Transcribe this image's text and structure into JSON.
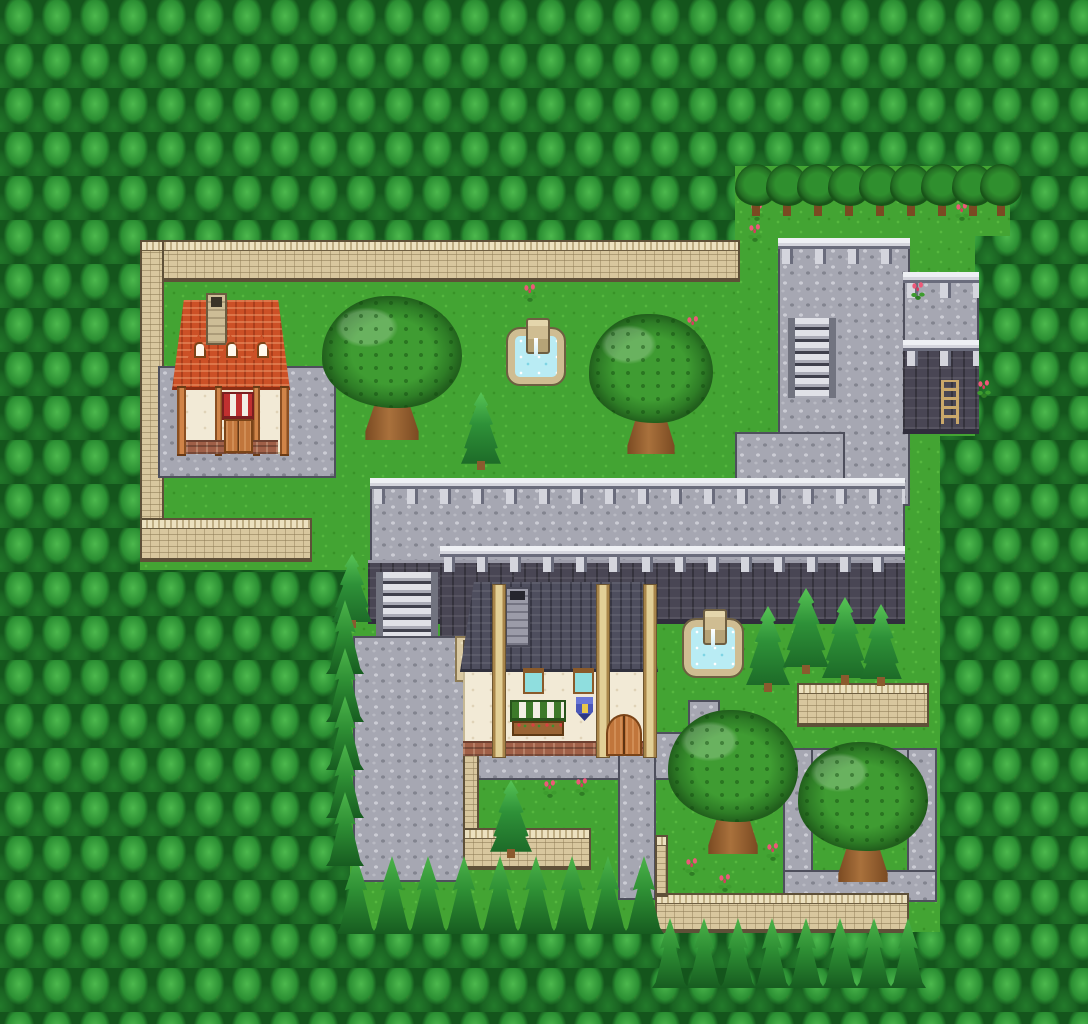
{
  "map": {
    "width": 1088,
    "height": 1024,
    "scene": "forest-town-map",
    "palette": {
      "grass": "#43a433",
      "grass_light": "#55b73e",
      "grass_dark": "#389327",
      "forest_dark": "#14551c",
      "forest_mid": "#2b8f33",
      "forest_light": "#4cb84d",
      "trunk_brown": "#8a5a2e",
      "cobble": "#a6a7b2",
      "cobble_light": "#cbccd4",
      "cobble_dark": "#82848f",
      "stone_border": "#4e4f5c",
      "step_light": "#e0e1e7",
      "step_dark": "#3f404c",
      "cliff": "#494654",
      "cliff_dark": "#302e3c",
      "cliff_cap": "#9b9ba8",
      "tan_cap": "#ece1bf",
      "tan_body": "#d8c79e",
      "tan_brick": "#b7a67c",
      "tan_dark": "#8c7a54",
      "roof_red": "#cc5026",
      "roof_red_dark": "#8c2e14",
      "roof_slate": "#4e4e5e",
      "roof_slate_dark": "#30303c",
      "cream": "#f2ead6",
      "wood": "#c1763c",
      "wood_dark": "#7a4418",
      "beam_tan": "#e2cf96",
      "water": "#b9ecf4",
      "fountain_stone": "#cfbd92",
      "fountain_stone_dark": "#6e5f42",
      "flower_pink": "#ee5878",
      "awning_green": "#3d7a2a",
      "awning_red": "#c03030",
      "awning_white": "#f2efe4",
      "shield_blue": "#4a57b8",
      "window_teal": "#8fdede",
      "brick_red": "#a06048",
      "rail_light": "#d4d5dd",
      "rail_dark": "#6a6c7c",
      "leaf_mid": "#3f9c32"
    },
    "elements": [
      {
        "n": "grass-upper-courtyard",
        "t": "grass",
        "x": 140,
        "y": 240,
        "w": 602,
        "h": 330
      },
      {
        "n": "grass-northeast-a",
        "t": "grass",
        "x": 735,
        "y": 166,
        "w": 275,
        "h": 70
      },
      {
        "n": "grass-northeast-b",
        "t": "grass",
        "x": 735,
        "y": 236,
        "w": 240,
        "h": 200
      },
      {
        "n": "grass-east",
        "t": "grass",
        "x": 735,
        "y": 436,
        "w": 205,
        "h": 126
      },
      {
        "n": "grass-south",
        "t": "grass",
        "x": 350,
        "y": 556,
        "w": 590,
        "h": 376
      },
      {
        "n": "stone-terrace-platform",
        "t": "cobble",
        "x": 778,
        "y": 244,
        "w": 132,
        "h": 262
      },
      {
        "n": "stone-terrace-annex",
        "t": "cobble",
        "x": 903,
        "y": 278,
        "w": 76,
        "h": 72
      },
      {
        "n": "terrace-connector",
        "t": "cobble",
        "x": 735,
        "y": 432,
        "w": 110,
        "h": 76
      },
      {
        "n": "elevated-walkway",
        "t": "cobble",
        "x": 370,
        "y": 484,
        "w": 535,
        "h": 80
      },
      {
        "n": "cliff-wall",
        "t": "cliff",
        "x": 368,
        "y": 560,
        "w": 537,
        "h": 64
      },
      {
        "n": "cliff-wall-corner",
        "t": "cliff",
        "x": 440,
        "y": 560,
        "w": 74,
        "h": 82
      },
      {
        "n": "annex-cliff-wall",
        "t": "cliff",
        "x": 903,
        "y": 346,
        "w": 76,
        "h": 88
      },
      {
        "n": "annex-ladder",
        "t": "ladder",
        "x": 941,
        "y": 380,
        "w": 18,
        "h": 44,
        "i": true
      },
      {
        "n": "platform-railing",
        "t": "railing",
        "x": 778,
        "y": 238,
        "w": 132,
        "h": 26
      },
      {
        "n": "annex-railing-top",
        "t": "railing",
        "x": 903,
        "y": 272,
        "w": 76,
        "h": 26
      },
      {
        "n": "annex-railing-mid",
        "t": "railing",
        "x": 903,
        "y": 340,
        "w": 76,
        "h": 26
      },
      {
        "n": "walkway-railing",
        "t": "railing",
        "x": 370,
        "y": 478,
        "w": 535,
        "h": 26
      },
      {
        "n": "cliff-top-railing",
        "t": "railing",
        "x": 440,
        "y": 546,
        "w": 465,
        "h": 26
      },
      {
        "n": "platform-stairs",
        "t": "stairs",
        "x": 788,
        "y": 318,
        "w": 48,
        "h": 80,
        "i": true
      },
      {
        "n": "walkway-stairs",
        "t": "stairs",
        "x": 376,
        "y": 572,
        "w": 62,
        "h": 94,
        "i": true
      },
      {
        "n": "north-wall",
        "t": "tanwall-h",
        "x": 140,
        "y": 240,
        "w": 600,
        "h": 42
      },
      {
        "n": "west-wall",
        "t": "tanwall-v",
        "x": 140,
        "y": 240,
        "w": 24,
        "h": 292
      },
      {
        "n": "west-wall-return",
        "t": "tanwall-h",
        "x": 140,
        "y": 518,
        "w": 172,
        "h": 44
      },
      {
        "n": "inn-patio",
        "t": "cobble",
        "x": 158,
        "y": 366,
        "w": 178,
        "h": 112
      },
      {
        "n": "inn-wall",
        "t": "wall-cream",
        "x": 177,
        "y": 388,
        "w": 112,
        "h": 66
      },
      {
        "n": "inn-roof",
        "t": "roof-red",
        "x": 172,
        "y": 300,
        "w": 118,
        "h": 90
      },
      {
        "n": "inn-chimney",
        "t": "chimney-stone",
        "x": 206,
        "y": 293,
        "w": 21,
        "h": 52
      },
      {
        "n": "inn-dormer",
        "t": "dormer",
        "x": 188,
        "y": 334,
        "w": 21,
        "h": 26
      },
      {
        "n": "inn-dormer",
        "t": "dormer",
        "x": 220,
        "y": 334,
        "w": 21,
        "h": 26
      },
      {
        "n": "inn-dormer",
        "t": "dormer",
        "x": 251,
        "y": 334,
        "w": 21,
        "h": 26
      },
      {
        "n": "inn-post",
        "t": "post-wood",
        "x": 177,
        "y": 386,
        "w": 9,
        "h": 70
      },
      {
        "n": "inn-post",
        "t": "post-wood",
        "x": 215,
        "y": 386,
        "w": 7,
        "h": 70
      },
      {
        "n": "inn-post",
        "t": "post-wood",
        "x": 253,
        "y": 386,
        "w": 7,
        "h": 70
      },
      {
        "n": "inn-post",
        "t": "post-wood",
        "x": 280,
        "y": 386,
        "w": 9,
        "h": 70
      },
      {
        "n": "inn-awning",
        "t": "awning-red",
        "x": 222,
        "y": 392,
        "w": 32,
        "h": 28
      },
      {
        "n": "inn-foundation",
        "t": "brick-base",
        "x": 186,
        "y": 440,
        "w": 92,
        "h": 14
      },
      {
        "n": "inn-door",
        "t": "door-wood",
        "x": 224,
        "y": 419,
        "w": 29,
        "h": 34,
        "i": true
      },
      {
        "n": "south-plaza",
        "t": "cobble",
        "x": 353,
        "y": 636,
        "w": 112,
        "h": 246
      },
      {
        "n": "shop-front-path",
        "t": "cobble",
        "x": 465,
        "y": 732,
        "w": 235,
        "h": 48
      },
      {
        "n": "south-path",
        "t": "cobble",
        "x": 618,
        "y": 732,
        "w": 38,
        "h": 168
      },
      {
        "n": "fountain-path-stub",
        "t": "cobble",
        "x": 688,
        "y": 700,
        "w": 32,
        "h": 52
      },
      {
        "n": "garden-path-north",
        "t": "cobble",
        "x": 700,
        "y": 748,
        "w": 237,
        "h": 36
      },
      {
        "n": "garden-path-west",
        "t": "cobble",
        "x": 783,
        "y": 748,
        "w": 30,
        "h": 154
      },
      {
        "n": "garden-path-east",
        "t": "cobble",
        "x": 907,
        "y": 748,
        "w": 30,
        "h": 154
      },
      {
        "n": "garden-path-south",
        "t": "cobble",
        "x": 783,
        "y": 870,
        "w": 154,
        "h": 32
      },
      {
        "n": "side-yard",
        "t": "tan-floor",
        "x": 455,
        "y": 636,
        "w": 48,
        "h": 46
      },
      {
        "n": "yard-wall-vertical",
        "t": "tanwall-v",
        "x": 463,
        "y": 640,
        "w": 16,
        "h": 192
      },
      {
        "n": "yard-wall",
        "t": "tanwall-h",
        "x": 463,
        "y": 828,
        "w": 128,
        "h": 42
      },
      {
        "n": "south-wall",
        "t": "tanwall-h",
        "x": 655,
        "y": 893,
        "w": 254,
        "h": 40
      },
      {
        "n": "south-wall-stub",
        "t": "tanwall-v",
        "x": 655,
        "y": 835,
        "w": 13,
        "h": 62
      },
      {
        "n": "garden-wall",
        "t": "tanwall-h",
        "x": 797,
        "y": 683,
        "w": 132,
        "h": 44
      },
      {
        "n": "fountain",
        "t": "fountain",
        "x": 508,
        "y": 329,
        "w": 56,
        "h": 55
      },
      {
        "n": "oak-tree",
        "t": "big-tree",
        "x": 322,
        "y": 296,
        "w": 140,
        "h": 144
      },
      {
        "n": "oak-tree",
        "t": "big-tree",
        "x": 589,
        "y": 314,
        "w": 124,
        "h": 140
      },
      {
        "n": "grove-tree",
        "t": "small-tree",
        "x": 735,
        "y": 164,
        "w": 42,
        "h": 52
      },
      {
        "n": "grove-tree",
        "t": "small-tree",
        "x": 766,
        "y": 164,
        "w": 42,
        "h": 52
      },
      {
        "n": "grove-tree",
        "t": "small-tree",
        "x": 797,
        "y": 164,
        "w": 42,
        "h": 52
      },
      {
        "n": "grove-tree",
        "t": "small-tree",
        "x": 828,
        "y": 164,
        "w": 42,
        "h": 52
      },
      {
        "n": "grove-tree",
        "t": "small-tree",
        "x": 859,
        "y": 164,
        "w": 42,
        "h": 52
      },
      {
        "n": "grove-tree",
        "t": "small-tree",
        "x": 890,
        "y": 164,
        "w": 42,
        "h": 52
      },
      {
        "n": "grove-tree",
        "t": "small-tree",
        "x": 921,
        "y": 164,
        "w": 42,
        "h": 52
      },
      {
        "n": "grove-tree",
        "t": "small-tree",
        "x": 952,
        "y": 164,
        "w": 42,
        "h": 52
      },
      {
        "n": "grove-tree",
        "t": "small-tree",
        "x": 980,
        "y": 164,
        "w": 42,
        "h": 52
      },
      {
        "n": "shop-wall",
        "t": "wall-cream",
        "x": 463,
        "y": 666,
        "w": 193,
        "h": 90
      },
      {
        "n": "shop-roof",
        "t": "roof-slate",
        "x": 460,
        "y": 582,
        "w": 198,
        "h": 90
      },
      {
        "n": "shop-chimney",
        "t": "chimney-slate",
        "x": 505,
        "y": 587,
        "w": 25,
        "h": 60
      },
      {
        "n": "shop-foundation",
        "t": "brick-base",
        "x": 463,
        "y": 741,
        "w": 193,
        "h": 15
      },
      {
        "n": "shop-beam",
        "t": "beam",
        "x": 492,
        "y": 584,
        "w": 14,
        "h": 174
      },
      {
        "n": "shop-beam",
        "t": "beam",
        "x": 596,
        "y": 584,
        "w": 14,
        "h": 174
      },
      {
        "n": "shop-beam",
        "t": "beam",
        "x": 643,
        "y": 584,
        "w": 14,
        "h": 174
      },
      {
        "n": "shop-window",
        "t": "window",
        "x": 523,
        "y": 668,
        "w": 21,
        "h": 26
      },
      {
        "n": "shop-window",
        "t": "window",
        "x": 573,
        "y": 668,
        "w": 21,
        "h": 26
      },
      {
        "n": "shop-awning",
        "t": "awning-green",
        "x": 510,
        "y": 700,
        "w": 56,
        "h": 22
      },
      {
        "n": "shop-flowerbox",
        "t": "flowerbox",
        "x": 512,
        "y": 721,
        "w": 52,
        "h": 15
      },
      {
        "n": "shop-sign-shield",
        "t": "shield",
        "x": 576,
        "y": 697,
        "w": 17,
        "h": 24
      },
      {
        "n": "shop-door",
        "t": "door-arch",
        "x": 606,
        "y": 714,
        "w": 36,
        "h": 42,
        "i": true
      },
      {
        "n": "fountain",
        "t": "fountain",
        "x": 684,
        "y": 620,
        "w": 58,
        "h": 56
      },
      {
        "n": "cypress-tree",
        "t": "conifer",
        "x": 461,
        "y": 392,
        "w": 40,
        "h": 78
      },
      {
        "n": "cypress-tree",
        "t": "conifer",
        "x": 332,
        "y": 554,
        "w": 40,
        "h": 74
      },
      {
        "n": "cypress-tree",
        "t": "conifer",
        "x": 746,
        "y": 606,
        "w": 44,
        "h": 86
      },
      {
        "n": "cypress-tree",
        "t": "conifer",
        "x": 783,
        "y": 588,
        "w": 46,
        "h": 86
      },
      {
        "n": "cypress-tree",
        "t": "conifer",
        "x": 822,
        "y": 597,
        "w": 46,
        "h": 88
      },
      {
        "n": "cypress-tree",
        "t": "conifer",
        "x": 860,
        "y": 604,
        "w": 42,
        "h": 82
      },
      {
        "n": "cypress-tree",
        "t": "conifer",
        "x": 490,
        "y": 780,
        "w": 42,
        "h": 78
      },
      {
        "n": "oak-tree",
        "t": "big-tree",
        "x": 668,
        "y": 710,
        "w": 130,
        "h": 144
      },
      {
        "n": "oak-tree",
        "t": "big-tree",
        "x": 798,
        "y": 742,
        "w": 130,
        "h": 140
      },
      {
        "n": "flower-patch",
        "t": "flower",
        "x": 521,
        "y": 284,
        "w": 18,
        "h": 18
      },
      {
        "n": "flower-patch",
        "t": "flower",
        "x": 684,
        "y": 316,
        "w": 18,
        "h": 18
      },
      {
        "n": "flower-patch",
        "t": "flower",
        "x": 748,
        "y": 203,
        "w": 18,
        "h": 18
      },
      {
        "n": "flower-patch",
        "t": "flower",
        "x": 746,
        "y": 224,
        "w": 18,
        "h": 18
      },
      {
        "n": "flower-patch",
        "t": "flower",
        "x": 953,
        "y": 203,
        "w": 18,
        "h": 18
      },
      {
        "n": "flower-patch",
        "t": "flower",
        "x": 909,
        "y": 282,
        "w": 18,
        "h": 18
      },
      {
        "n": "flower-patch",
        "t": "flower",
        "x": 541,
        "y": 780,
        "w": 18,
        "h": 18
      },
      {
        "n": "flower-patch",
        "t": "flower",
        "x": 573,
        "y": 778,
        "w": 18,
        "h": 18
      },
      {
        "n": "flower-patch",
        "t": "flower",
        "x": 683,
        "y": 858,
        "w": 18,
        "h": 18
      },
      {
        "n": "flower-patch",
        "t": "flower",
        "x": 716,
        "y": 874,
        "w": 18,
        "h": 18
      },
      {
        "n": "flower-patch",
        "t": "flower",
        "x": 764,
        "y": 843,
        "w": 18,
        "h": 18
      },
      {
        "n": "flower-patch",
        "t": "flower",
        "x": 975,
        "y": 380,
        "w": 18,
        "h": 18
      },
      {
        "n": "forest-pine",
        "t": "pine",
        "x": 336,
        "y": 856,
        "w": 40,
        "h": 78
      },
      {
        "n": "forest-pine",
        "t": "pine",
        "x": 372,
        "y": 856,
        "w": 40,
        "h": 78
      },
      {
        "n": "forest-pine",
        "t": "pine",
        "x": 408,
        "y": 856,
        "w": 40,
        "h": 78
      },
      {
        "n": "forest-pine",
        "t": "pine",
        "x": 444,
        "y": 856,
        "w": 40,
        "h": 78
      },
      {
        "n": "forest-pine",
        "t": "pine",
        "x": 480,
        "y": 856,
        "w": 40,
        "h": 78
      },
      {
        "n": "forest-pine",
        "t": "pine",
        "x": 516,
        "y": 856,
        "w": 40,
        "h": 78
      },
      {
        "n": "forest-pine",
        "t": "pine",
        "x": 552,
        "y": 856,
        "w": 40,
        "h": 78
      },
      {
        "n": "forest-pine",
        "t": "pine",
        "x": 588,
        "y": 856,
        "w": 40,
        "h": 78
      },
      {
        "n": "forest-pine",
        "t": "pine",
        "x": 624,
        "y": 856,
        "w": 40,
        "h": 78
      },
      {
        "n": "forest-pine",
        "t": "pine",
        "x": 652,
        "y": 918,
        "w": 36,
        "h": 70
      },
      {
        "n": "forest-pine",
        "t": "pine",
        "x": 686,
        "y": 918,
        "w": 36,
        "h": 70
      },
      {
        "n": "forest-pine",
        "t": "pine",
        "x": 720,
        "y": 918,
        "w": 36,
        "h": 70
      },
      {
        "n": "forest-pine",
        "t": "pine",
        "x": 754,
        "y": 918,
        "w": 36,
        "h": 70
      },
      {
        "n": "forest-pine",
        "t": "pine",
        "x": 788,
        "y": 918,
        "w": 36,
        "h": 70
      },
      {
        "n": "forest-pine",
        "t": "pine",
        "x": 822,
        "y": 918,
        "w": 36,
        "h": 70
      },
      {
        "n": "forest-pine",
        "t": "pine",
        "x": 856,
        "y": 918,
        "w": 36,
        "h": 70
      },
      {
        "n": "forest-pine",
        "t": "pine",
        "x": 890,
        "y": 918,
        "w": 36,
        "h": 70
      },
      {
        "n": "forest-pine",
        "t": "pine",
        "x": 326,
        "y": 600,
        "w": 38,
        "h": 74
      },
      {
        "n": "forest-pine",
        "t": "pine",
        "x": 326,
        "y": 648,
        "w": 38,
        "h": 74
      },
      {
        "n": "forest-pine",
        "t": "pine",
        "x": 326,
        "y": 696,
        "w": 38,
        "h": 74
      },
      {
        "n": "forest-pine",
        "t": "pine",
        "x": 326,
        "y": 744,
        "w": 38,
        "h": 74
      },
      {
        "n": "forest-pine",
        "t": "pine",
        "x": 326,
        "y": 792,
        "w": 38,
        "h": 74
      }
    ]
  }
}
